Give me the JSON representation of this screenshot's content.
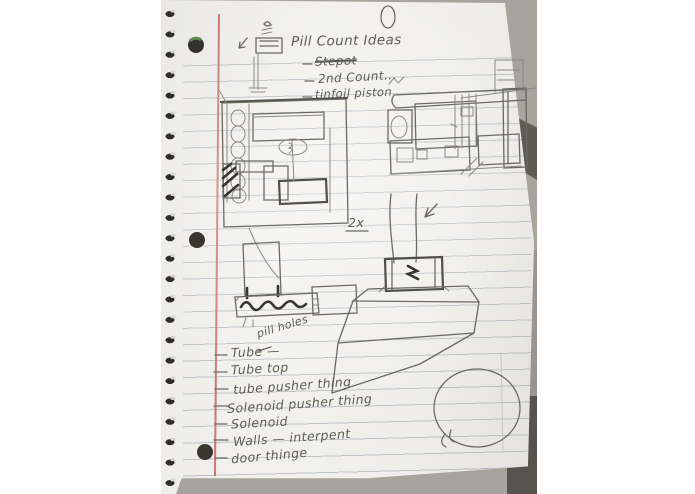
{
  "page": {
    "title": "Pill Count Ideas",
    "idea_bullets": [
      {
        "text": "Stepot",
        "struck": true
      },
      {
        "text": "2nd Count...",
        "struck": false
      },
      {
        "text": "tinfoil piston",
        "struck": false
      }
    ],
    "sketch_labels": {
      "quantity": "2x",
      "tube_note": "pill holes"
    },
    "parts_list": [
      {
        "text": "Tube —"
      },
      {
        "text": "Tube top"
      },
      {
        "text": "tube pusher thing"
      },
      {
        "text": "Solenoid pusher thing"
      },
      {
        "text": "Solenoid"
      },
      {
        "text": "Walls — interpent"
      },
      {
        "text": "door thinge"
      }
    ],
    "colors": {
      "paper": "#f0efec",
      "ruled_line": "#b7bbc1",
      "margin_line": "#c05a52",
      "pencil": "#6b6a65",
      "table": "#a7a39d",
      "table_shadow": "#57534d"
    }
  }
}
